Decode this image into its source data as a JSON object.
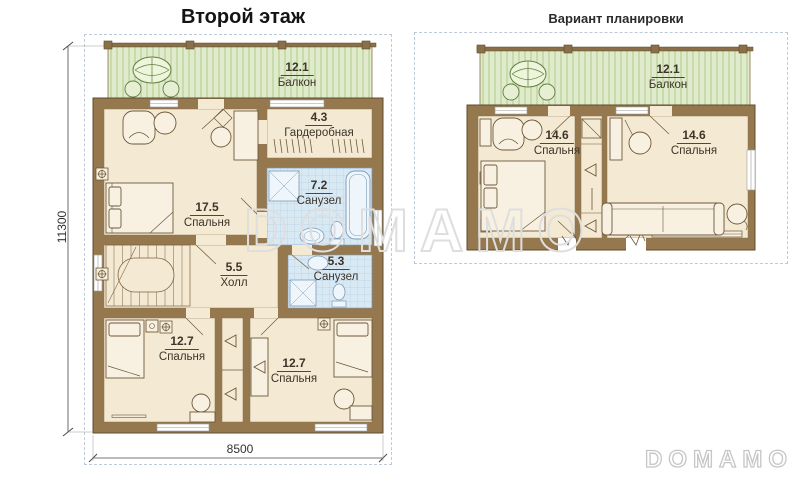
{
  "header": {
    "main_title": "Второй этаж",
    "variant_title": "Вариант планировки"
  },
  "watermark": {
    "center_text": "DOMAMO",
    "logo_text": "DOMAMO"
  },
  "dimensions": {
    "height_mm": "11300",
    "width_mm": "8500"
  },
  "plans": {
    "main": {
      "rooms": [
        {
          "id": "balcony",
          "area": "12.1",
          "name": "Балкон"
        },
        {
          "id": "wardrobe",
          "area": "4.3",
          "name": "Гардеробная"
        },
        {
          "id": "bathroom_top",
          "area": "7.2",
          "name": "Санузел"
        },
        {
          "id": "bedroom_large",
          "area": "17.5",
          "name": "Спальня"
        },
        {
          "id": "hall",
          "area": "5.5",
          "name": "Холл"
        },
        {
          "id": "bathroom_bottom",
          "area": "5.3",
          "name": "Санузел"
        },
        {
          "id": "bedroom_bottom_left",
          "area": "12.7",
          "name": "Спальня"
        },
        {
          "id": "bedroom_bottom_right",
          "area": "12.7",
          "name": "Спальня"
        }
      ]
    },
    "variant": {
      "rooms": [
        {
          "id": "balcony",
          "area": "12.1",
          "name": "Балкон"
        },
        {
          "id": "bedroom_left",
          "area": "14.6",
          "name": "Спальня"
        },
        {
          "id": "bedroom_right",
          "area": "14.6",
          "name": "Спальня"
        }
      ]
    }
  },
  "colors": {
    "wall": "#95784e",
    "floor": "#f4ead3",
    "balcony_deck": "#e0ebcd",
    "bathroom_tile": "#d9e9f4",
    "frame_dash": "#bfcad8",
    "watermark": "#dedede"
  }
}
